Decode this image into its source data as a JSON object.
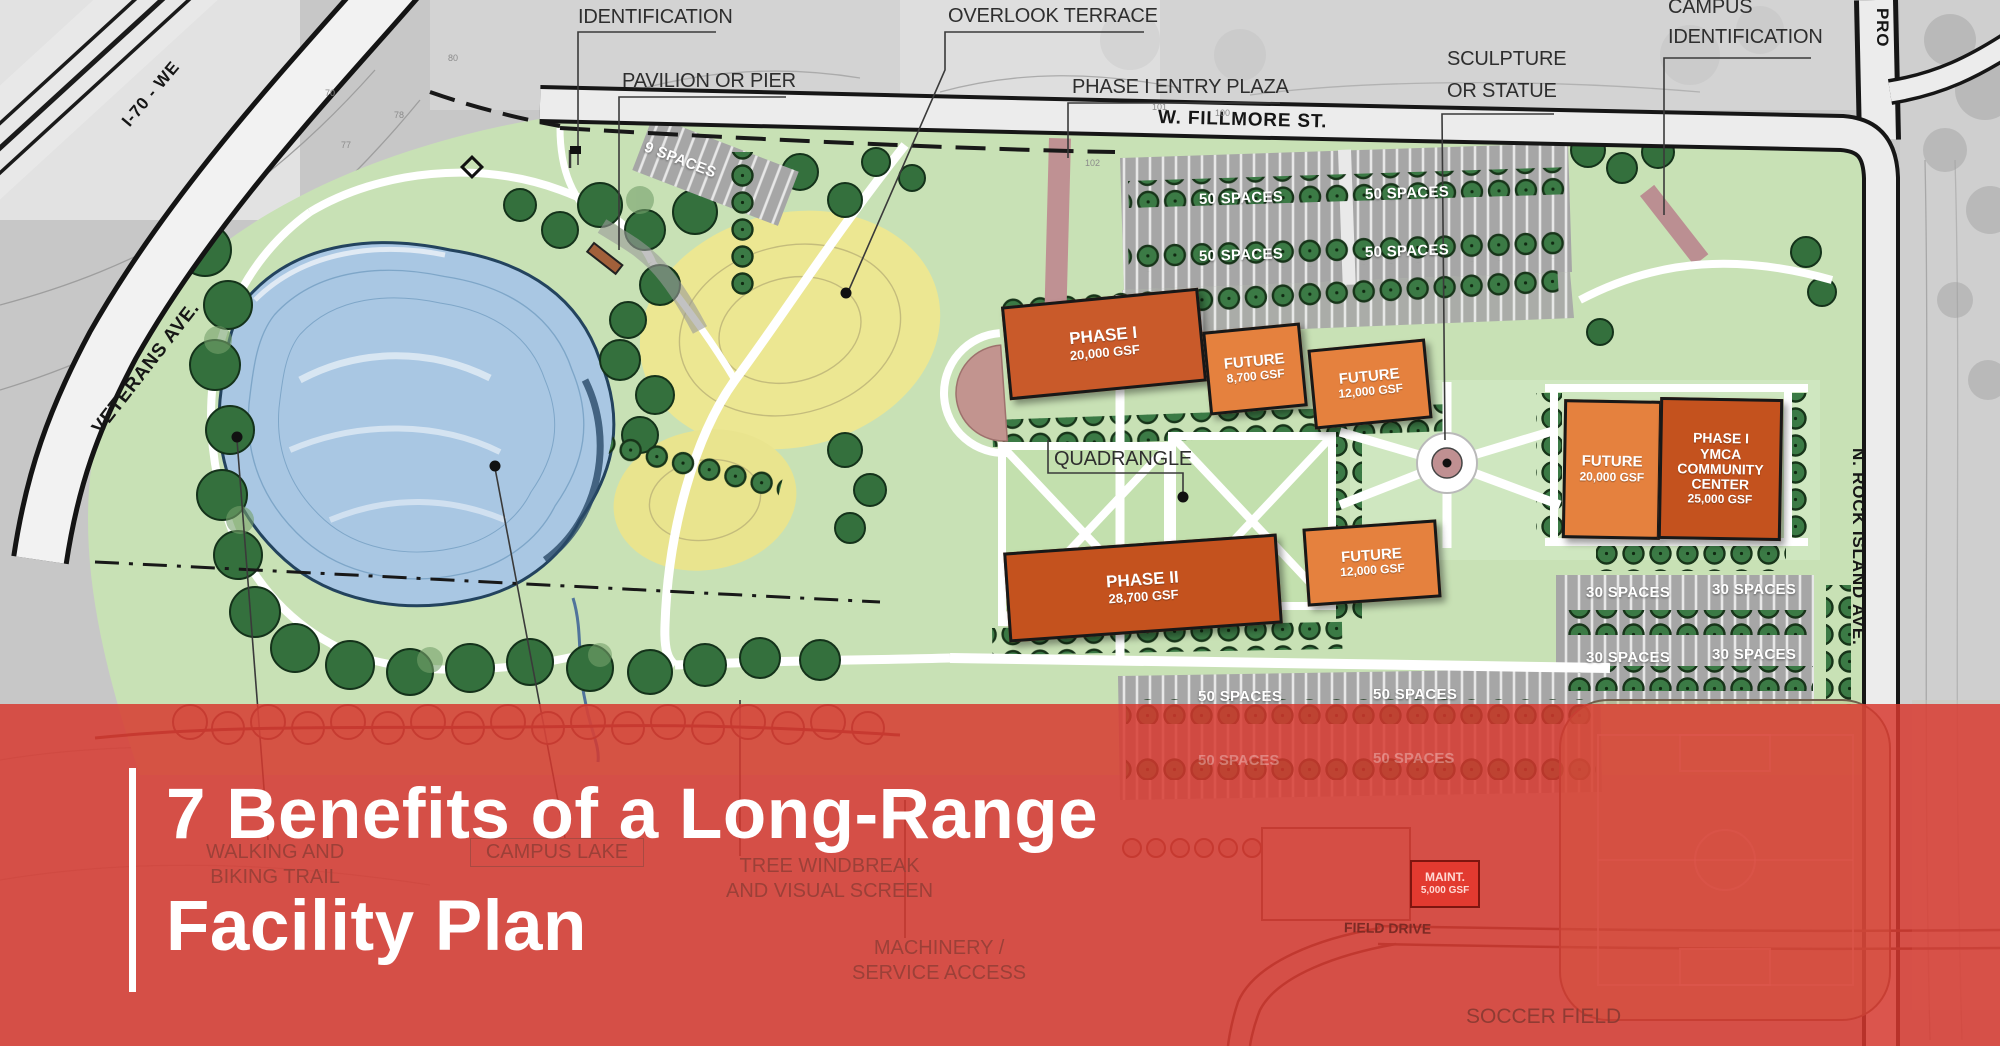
{
  "banner": {
    "title_line1": "7 Benefits of a Long-Range",
    "title_line2": "Facility Plan",
    "overlay_color": "#d8382f"
  },
  "roads": {
    "fillmore": "W. FILLMORE ST.",
    "veterans": "VETERANS AVE.",
    "i70": "I-70 - WE",
    "rock_island": "N. ROCK ISLAND AVE.",
    "prospect": "PRO",
    "field_drive": "FIELD DRIVE"
  },
  "callouts": {
    "identification": "IDENTIFICATION",
    "pavilion": "PAVILION OR PIER",
    "overlook": "OVERLOOK TERRACE",
    "entry_plaza": "PHASE I  ENTRY PLAZA",
    "sculpture_l1": "SCULPTURE",
    "sculpture_l2": "OR STATUE",
    "campus_id_l1": "CAMPUS",
    "campus_id_l2": "IDENTIFICATION",
    "quadrangle": "QUADRANGLE",
    "walking_l1": "WALKING AND",
    "walking_l2": "BIKING TRAIL",
    "campus_lake": "CAMPUS LAKE",
    "windbreak_l1": "TREE WINDBREAK",
    "windbreak_l2": "AND VISUAL SCREEN",
    "machinery_l1": "MACHINERY /",
    "machinery_l2": "SERVICE ACCESS",
    "soccer": "SOCCER FIELD"
  },
  "buildings": {
    "phase1": {
      "l1": "PHASE I",
      "l2": "20,000 GSF"
    },
    "future_a": {
      "l1": "FUTURE",
      "l2": "8,700 GSF"
    },
    "future_b": {
      "l1": "FUTURE",
      "l2": "12,000 GSF"
    },
    "future_c": {
      "l1": "FUTURE",
      "l2": "20,000 GSF"
    },
    "ymca": {
      "l1": "PHASE I",
      "l2": "YMCA",
      "l3": "COMMUNITY",
      "l4": "CENTER",
      "l5": "25,000 GSF"
    },
    "phase2": {
      "l1": "PHASE II",
      "l2": "28,700 GSF"
    },
    "future_d": {
      "l1": "FUTURE",
      "l2": "12,000 GSF"
    },
    "maint": {
      "l1": "MAINT.",
      "l2": "5,000 GSF"
    }
  },
  "parking": {
    "nine": "9 SPACES",
    "fifty": "50 SPACES",
    "thirty": "30 SPACES"
  },
  "contours": [
    "80",
    "70",
    "78",
    "77",
    "102",
    "101",
    "100"
  ]
}
